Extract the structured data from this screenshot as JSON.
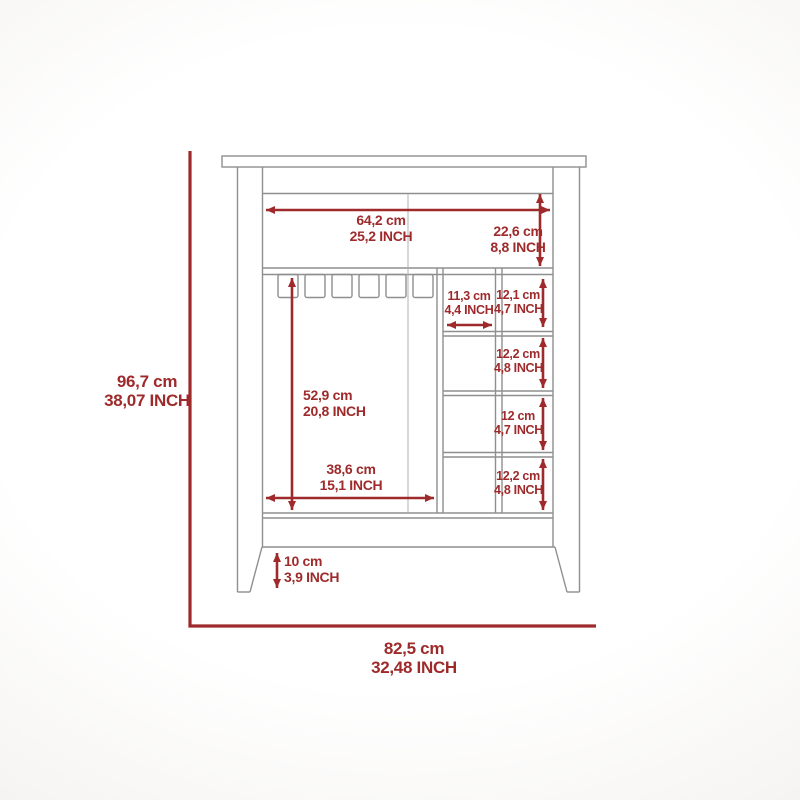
{
  "colors": {
    "dimension_red": "#9e2a2b",
    "outline_gray": "#8f8f8f",
    "background": "#ffffff"
  },
  "dims": {
    "overall_height": {
      "cm": "96,7 cm",
      "inch": "38,07 INCH"
    },
    "overall_width": {
      "cm": "82,5 cm",
      "inch": "32,48 INCH"
    },
    "top_opening_width": {
      "cm": "64,2 cm",
      "inch": "25,2 INCH"
    },
    "top_section_height": {
      "cm": "22,6 cm",
      "inch": "8,8 INCH"
    },
    "center_cubby_width": {
      "cm": "11,3 cm",
      "inch": "4,4 INCH"
    },
    "cubby_row1_height": {
      "cm": "12,1 cm",
      "inch": "4,7 INCH"
    },
    "cubby_row2_height": {
      "cm": "12,2 cm",
      "inch": "4,8 INCH"
    },
    "cubby_row3_height": {
      "cm": "12 cm",
      "inch": "4,7 INCH"
    },
    "cubby_row4_height": {
      "cm": "12,2 cm",
      "inch": "4,8 INCH"
    },
    "compartment_height": {
      "cm": "52,9 cm",
      "inch": "20,8 INCH"
    },
    "compartment_width": {
      "cm": "38,6 cm",
      "inch": "15,1 INCH"
    },
    "leg_height": {
      "cm": "10 cm",
      "inch": "3,9 INCH"
    }
  }
}
